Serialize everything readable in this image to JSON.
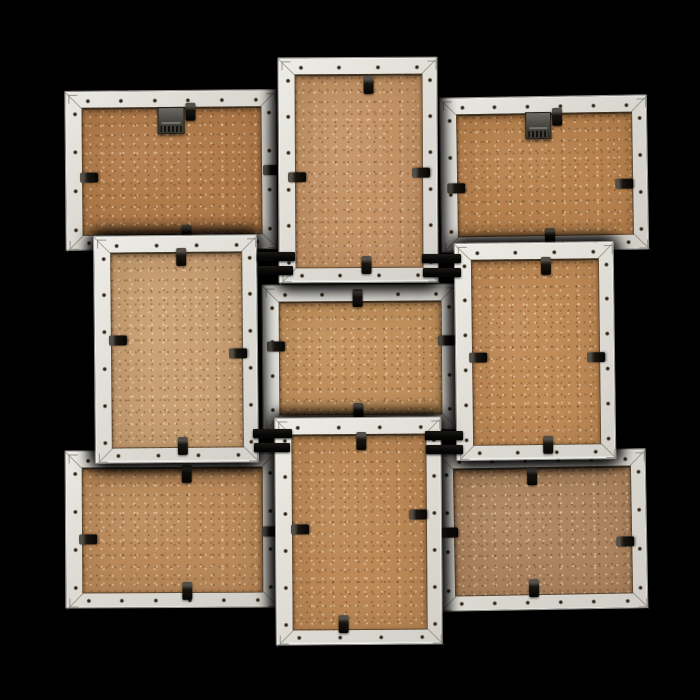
{
  "scene": {
    "width": 700,
    "height": 700,
    "background_color": "#000000",
    "subject": "back-view-of-white-3x3-collage-photo-frame"
  },
  "style": {
    "frame_border_width": 16,
    "frame_color": "#dcdad3",
    "frame_edge_color": "#94928c",
    "mdf_default_color": "#bc8a58",
    "clip_color": "#0d0b07",
    "hanger_color": "#45433e",
    "connector_color": "#0a0908"
  },
  "frames": [
    {
      "id": "top-left",
      "orientation": "landscape",
      "x": 65,
      "y": 90,
      "w": 212,
      "h": 160,
      "z": 1,
      "tilt": -0.5,
      "mdf": "#b27c4c",
      "hanger": {
        "x": 92,
        "y": 16,
        "w": 27,
        "h": 27
      },
      "clips": [
        {
          "dir": "v",
          "x": 125,
          "y": 21
        },
        {
          "dir": "h",
          "x": 23,
          "y": 86
        },
        {
          "dir": "h",
          "x": 206,
          "y": 80
        },
        {
          "dir": "v",
          "x": 120,
          "y": 143
        }
      ]
    },
    {
      "id": "top-center",
      "orientation": "portrait",
      "x": 278,
      "y": 57,
      "w": 160,
      "h": 226,
      "z": 3,
      "tilt": -0.3,
      "mdf": "#c49467",
      "clips": [
        {
          "dir": "v",
          "x": 90,
          "y": 27
        },
        {
          "dir": "h",
          "x": 18,
          "y": 119
        },
        {
          "dir": "h",
          "x": 142,
          "y": 115
        },
        {
          "dir": "v",
          "x": 87,
          "y": 207
        }
      ]
    },
    {
      "id": "top-right",
      "orientation": "landscape",
      "x": 440,
      "y": 96,
      "w": 208,
      "h": 155,
      "z": 1,
      "tilt": -0.9,
      "mdf": "#b8834f",
      "hanger": {
        "x": 85,
        "y": 15,
        "w": 26,
        "h": 27
      },
      "clips": [
        {
          "dir": "v",
          "x": 117,
          "y": 20
        },
        {
          "dir": "h",
          "x": 15,
          "y": 90
        },
        {
          "dir": "h",
          "x": 183,
          "y": 88
        },
        {
          "dir": "v",
          "x": 108,
          "y": 140
        }
      ]
    },
    {
      "id": "middle-left",
      "orientation": "portrait",
      "x": 94,
      "y": 235,
      "w": 164,
      "h": 228,
      "z": 3,
      "tilt": -0.5,
      "mdf": "#c9a074",
      "clips": [
        {
          "dir": "v",
          "x": 87,
          "y": 21
        },
        {
          "dir": "h",
          "x": 23,
          "y": 104
        },
        {
          "dir": "h",
          "x": 143,
          "y": 118
        },
        {
          "dir": "v",
          "x": 87,
          "y": 210
        }
      ]
    },
    {
      "id": "center",
      "orientation": "landscape",
      "x": 262,
      "y": 284,
      "w": 195,
      "h": 146,
      "z": 2,
      "tilt": -0.4,
      "mdf": "#c2925e",
      "clips": [
        {
          "dir": "v",
          "x": 95,
          "y": 13
        },
        {
          "dir": "h",
          "x": 13,
          "y": 61
        },
        {
          "dir": "h",
          "x": 184,
          "y": 56
        },
        {
          "dir": "v",
          "x": 95,
          "y": 127
        }
      ]
    },
    {
      "id": "middle-right",
      "orientation": "portrait",
      "x": 455,
      "y": 242,
      "w": 160,
      "h": 218,
      "z": 3,
      "tilt": -0.7,
      "mdf": "#bf8b57",
      "clips": [
        {
          "dir": "v",
          "x": 91,
          "y": 23
        },
        {
          "dir": "h",
          "x": 22,
          "y": 114
        },
        {
          "dir": "h",
          "x": 140,
          "y": 115
        },
        {
          "dir": "v",
          "x": 91,
          "y": 202
        }
      ]
    },
    {
      "id": "bottom-left",
      "orientation": "landscape",
      "x": 65,
      "y": 450,
      "w": 213,
      "h": 158,
      "z": 1,
      "tilt": -0.3,
      "mdf": "#bb8b5c",
      "clips": [
        {
          "dir": "v",
          "x": 121,
          "y": 23
        },
        {
          "dir": "h",
          "x": 22,
          "y": 88
        },
        {
          "dir": "h",
          "x": 205,
          "y": 81
        },
        {
          "dir": "v",
          "x": 121,
          "y": 140
        }
      ]
    },
    {
      "id": "bottom-center",
      "orientation": "portrait",
      "x": 275,
      "y": 417,
      "w": 167,
      "h": 228,
      "z": 3,
      "tilt": -0.4,
      "mdf": "#bc8957",
      "clips": [
        {
          "dir": "v",
          "x": 86,
          "y": 23
        },
        {
          "dir": "h",
          "x": 24,
          "y": 111
        },
        {
          "dir": "h",
          "x": 142,
          "y": 97
        },
        {
          "dir": "v",
          "x": 67,
          "y": 206
        }
      ]
    },
    {
      "id": "bottom-right",
      "orientation": "landscape",
      "x": 437,
      "y": 450,
      "w": 210,
      "h": 160,
      "z": 1,
      "tilt": -1.0,
      "mdf": "#ad8560",
      "clips": [
        {
          "dir": "v",
          "x": 95,
          "y": 25
        },
        {
          "dir": "h",
          "x": 11,
          "y": 80
        },
        {
          "dir": "h",
          "x": 187,
          "y": 92
        },
        {
          "dir": "v",
          "x": 95,
          "y": 137
        }
      ]
    }
  ],
  "connectors": [
    {
      "x": 257,
      "y": 252,
      "w": 38,
      "h": 9
    },
    {
      "x": 258,
      "y": 266,
      "w": 35,
      "h": 9
    },
    {
      "x": 422,
      "y": 254,
      "w": 39,
      "h": 9
    },
    {
      "x": 423,
      "y": 268,
      "w": 38,
      "h": 9
    },
    {
      "x": 253,
      "y": 429,
      "w": 39,
      "h": 9
    },
    {
      "x": 254,
      "y": 443,
      "w": 36,
      "h": 9
    },
    {
      "x": 425,
      "y": 431,
      "w": 38,
      "h": 9
    },
    {
      "x": 426,
      "y": 445,
      "w": 37,
      "h": 9
    }
  ]
}
